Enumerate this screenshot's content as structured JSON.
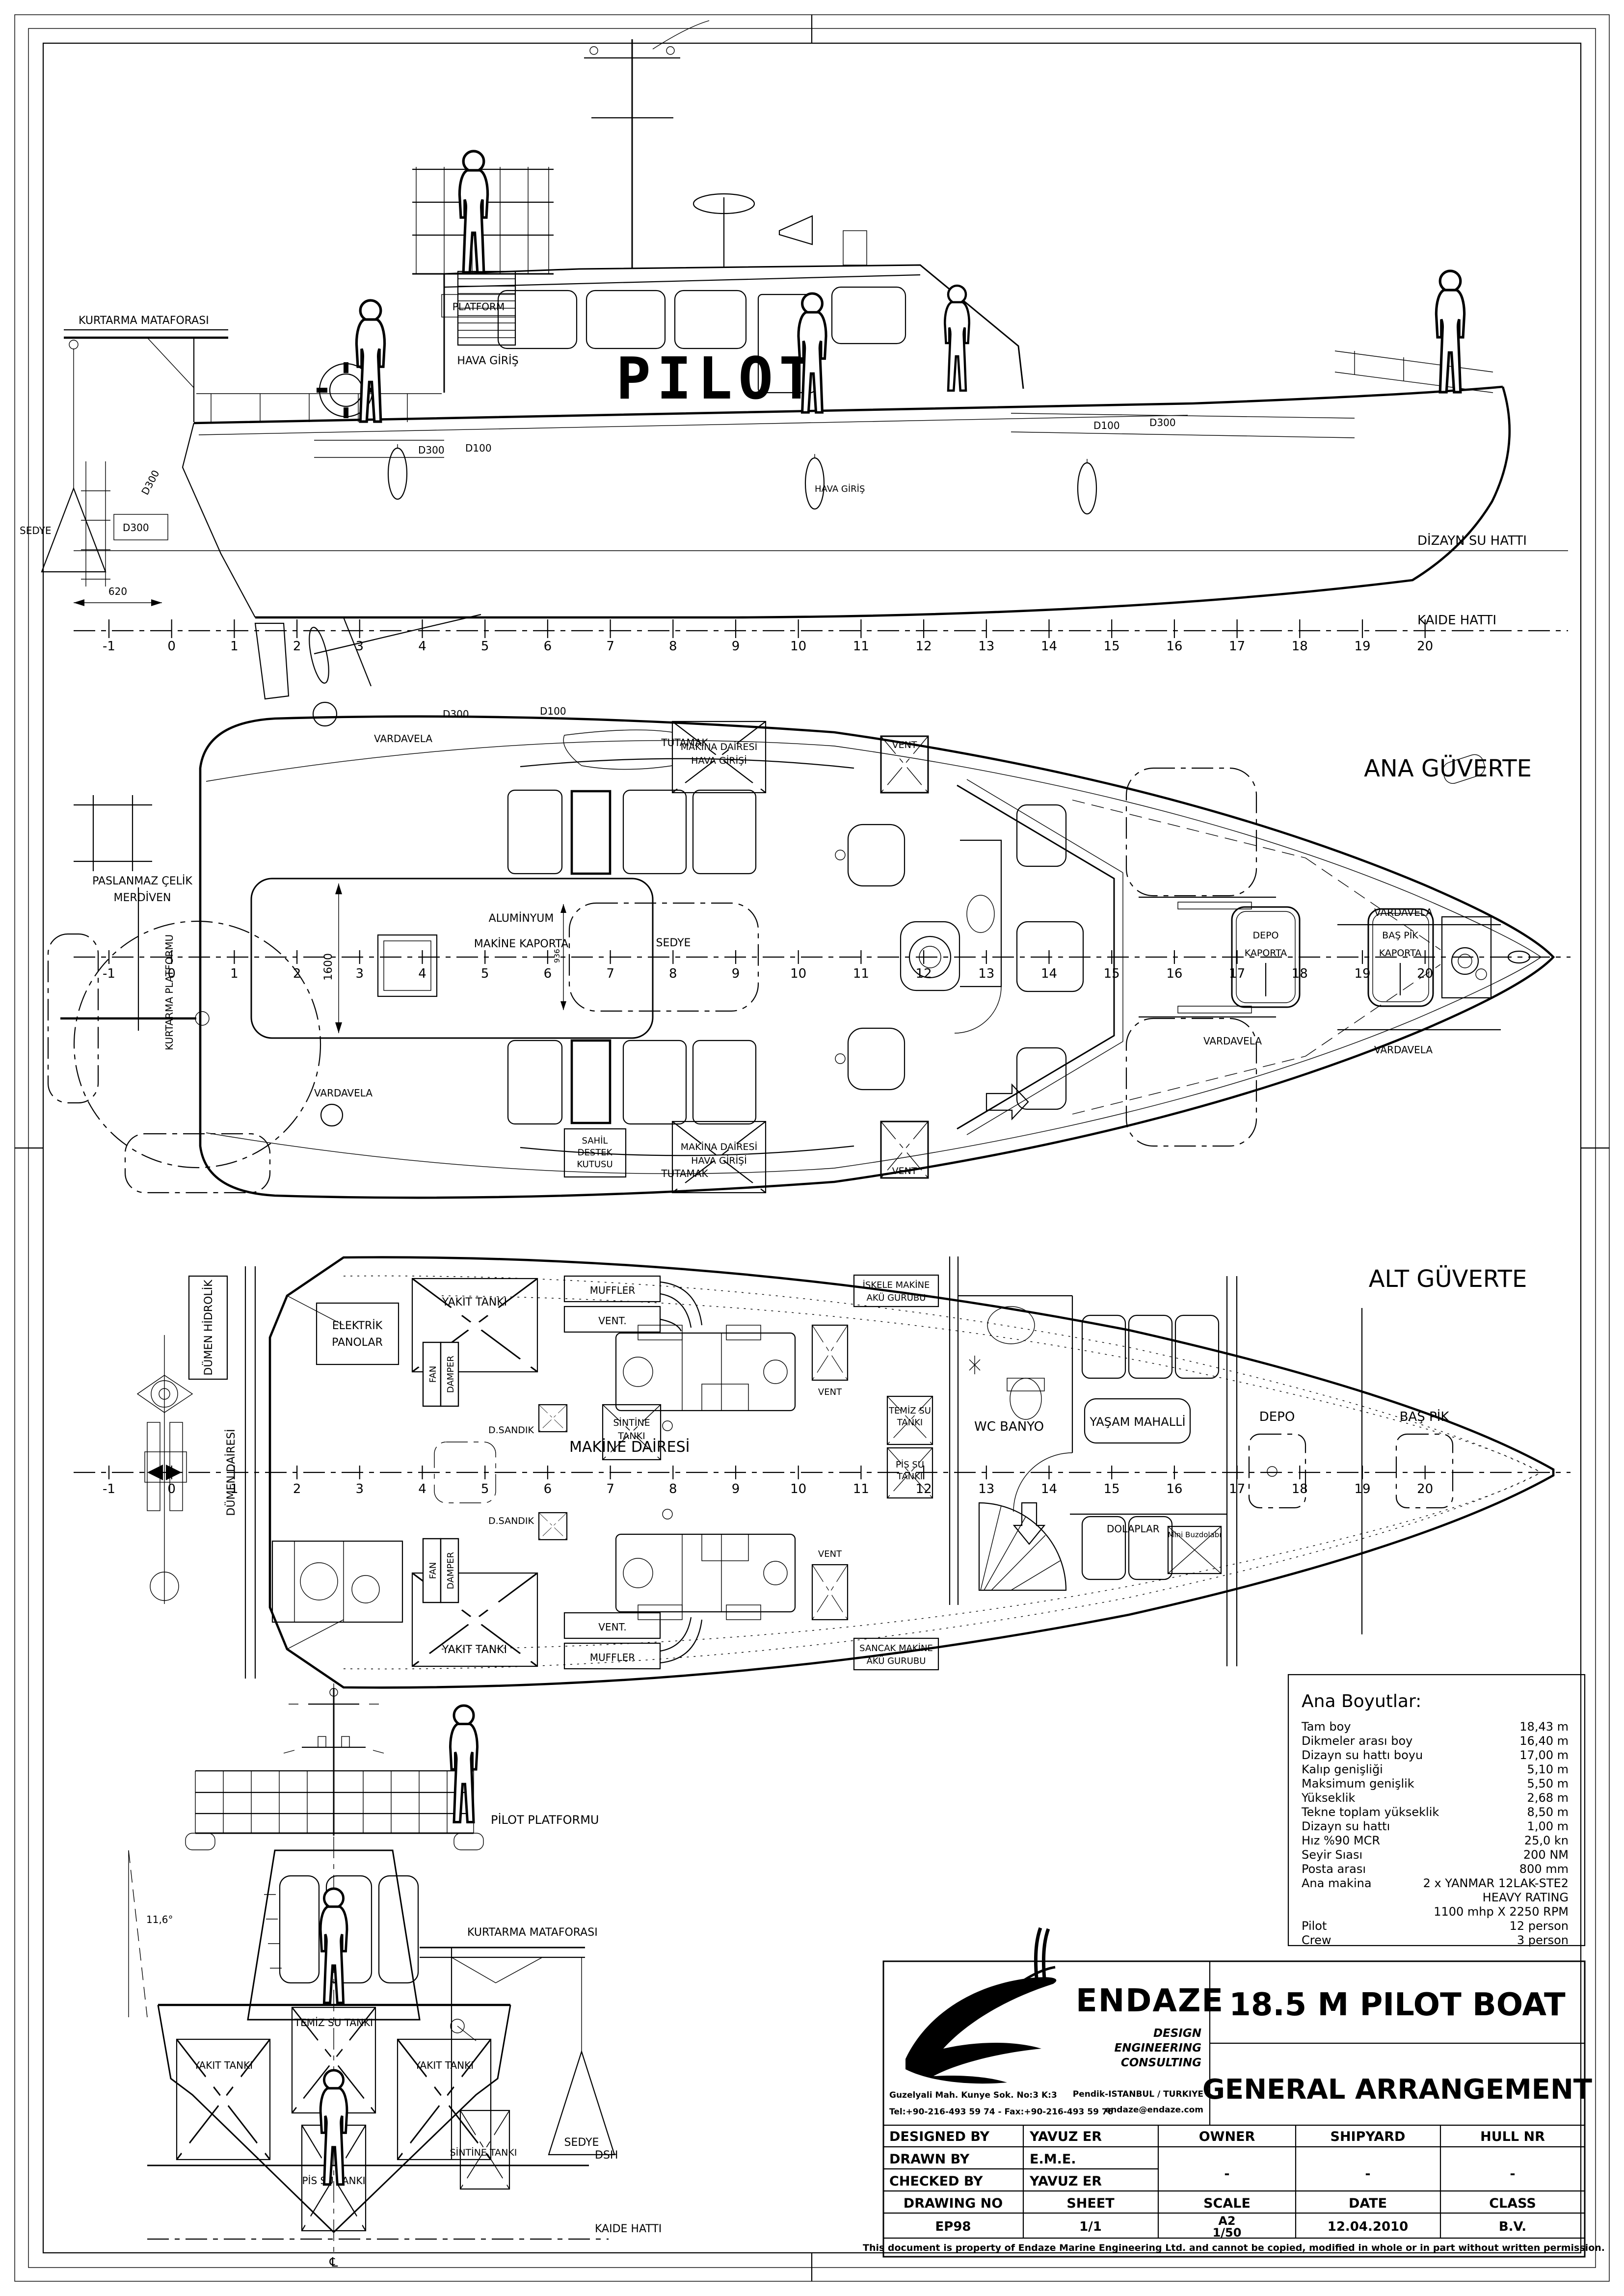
{
  "stations": [
    "-1",
    "0",
    "1",
    "2",
    "3",
    "4",
    "5",
    "6",
    "7",
    "8",
    "9",
    "10",
    "11",
    "12",
    "13",
    "14",
    "15",
    "16",
    "17",
    "18",
    "19",
    "20"
  ],
  "profile": {
    "kurtarma_mataforasi": "KURTARMA MATAFORASI",
    "sedye": "SEDYE",
    "dim_620": "620",
    "d300_stern_rot": "D300",
    "d300_stern": "D300",
    "platform": "PLATFORM",
    "hava_giris": "HAVA GİRİŞ",
    "hava_giris_2": "HAVA GİRİŞ",
    "pilot": "PILOT",
    "d300_aft": "D300",
    "d100_aft": "D100",
    "d100_fwd": "D100",
    "d300_fwd": "D300",
    "dizayn_su_hatti": "DİZAYN SU HATTI",
    "kaide_hatti": "KAIDE HATTI"
  },
  "main_deck": {
    "title": "ANA GÜVERTE",
    "vardavela_stern_top": "VARDAVELA",
    "vardavela_stern_bottom": "VARDAVELA",
    "vardavela_mid_bottom": "VARDAVELA",
    "vardavela_bow_top": "VARDAVELA",
    "vardavela_bow_bottom": "VARDAVELA",
    "d300": "D300",
    "d100": "D100",
    "tutamak_top": "TUTAMAK",
    "tutamak_bottom": "TUTAMAK",
    "paslanmaz_1": "PASLANMAZ ÇELİK",
    "paslanmaz_2": "MERDİVEN",
    "kurtarma_platformu": "KURTARMA PLATFORMU",
    "aluminyum": "ALUMİNYUM",
    "makine_kaporta": "MAKİNE KAPORTA",
    "dim_1600": "1600",
    "dim_936": "936",
    "sedye": "SEDYE",
    "hava_girisi_1": "MAKİNA DAİRESİ",
    "hava_girisi_2": "HAVA GİRİŞİ",
    "sahil_1": "SAHİL",
    "sahil_2": "DESTEK",
    "sahil_3": "KUTUSU",
    "vent_top": "VENT",
    "vent_bottom": "VENT",
    "depo_kaporta_1": "DEPO",
    "depo_kaporta_2": "KAPORTA",
    "bas_pik_kaporta_1": "BAŞ PİK",
    "bas_pik_kaporta_2": "KAPORTA"
  },
  "lower_deck": {
    "title": "ALT GÜVERTE",
    "elektrik_1": "ELEKTRİK",
    "elektrik_2": "PANOLAR",
    "yakit_tanki_top": "YAKIT TANKI",
    "yakit_tanki_bottom": "YAKIT TANKI",
    "fan_top": "FAN",
    "damper_top": "DAMPER",
    "fan_bottom": "FAN",
    "damper_bottom": "DAMPER",
    "muffler_top": "MUFFLER",
    "vent_dot_top": "VENT.",
    "muffler_bottom": "MUFFLER",
    "vent_dot_bottom": "VENT.",
    "vent_mid_top": "VENT",
    "vent_mid_bottom": "VENT",
    "iskele_1": "İSKELE MAKİNE",
    "iskele_2": "AKÜ GURUBU",
    "sancak_1": "SANCAK MAKİNE",
    "sancak_2": "AKÜ GURUBU",
    "makine_dairesi": "MAKİNE DAİRESİ",
    "d_sandik_top": "D.SANDIK",
    "d_sandik_bottom": "D.SANDIK",
    "sintine_1": "SİNTİNE",
    "sintine_2": "TANKI",
    "temiz_1": "TEMİZ SU",
    "temiz_2": "TANKI",
    "pis_1": "PİS SU",
    "pis_2": "TANKI",
    "dumen_hidrolik": "DÜMEN HİDROLİK",
    "dumen_dairesi": "DÜMEN DAİRESİ",
    "wc_banyo": "WC BANYO",
    "yasam_mahalli": "YAŞAM MAHALLİ",
    "dolaplar": "DOLAPLAR",
    "mini_buzdolabi": "Mini Buzdolabı",
    "depo": "DEPO",
    "bas_pik": "BAŞ PİK"
  },
  "bow": {
    "pilot_platformu": "PİLOT PLATFORMU",
    "kurtarma_mataforasi": "KURTARMA MATAFORASI",
    "angle": "11,6°",
    "yakit_left": "YAKIT TANKI",
    "yakit_right": "YAKIT TANKI",
    "temiz": "TEMİZ SU TANKI",
    "pis": "PİS SU TANKI",
    "sintine": "SİNTİNE TANKI",
    "sedye": "SEDYE",
    "dsh": "DSH",
    "kaide_hatti": "KAIDE HATTI",
    "cl": "℄"
  },
  "specs": {
    "title": "Ana Boyutlar:",
    "rows": [
      {
        "l": "Tam boy",
        "v": "18,43 m"
      },
      {
        "l": "Dikmeler arası boy",
        "v": "16,40 m"
      },
      {
        "l": "Dizayn su hattı boyu",
        "v": "17,00 m"
      },
      {
        "l": "Kalıp genişliği",
        "v": "5,10 m"
      },
      {
        "l": "Maksimum genişlik",
        "v": "5,50 m"
      },
      {
        "l": "Yükseklik",
        "v": "2,68 m"
      },
      {
        "l": "Tekne toplam yükseklik",
        "v": "8,50 m"
      },
      {
        "l": "Dizayn su hattı",
        "v": "1,00 m"
      },
      {
        "l": "Hız %90 MCR",
        "v": "25,0 kn"
      },
      {
        "l": "Seyir Sıası",
        "v": "200 NM"
      },
      {
        "l": "Posta arası",
        "v": "800 mm"
      },
      {
        "l": "Ana makina",
        "v": "2 x YANMAR 12LAK-STE2"
      },
      {
        "l": "",
        "v": "HEAVY RATING"
      },
      {
        "l": "",
        "v": "1100 mhp X 2250 RPM"
      },
      {
        "l": "Pilot",
        "v": "12 person"
      },
      {
        "l": "Crew",
        "v": "3 person"
      }
    ]
  },
  "title_block": {
    "company": "ENDAZE",
    "tagline_1": "DESIGN",
    "tagline_2": "ENGINEERING",
    "tagline_3": "CONSULTING",
    "address_l1": "Guzelyali Mah. Kunye Sok. No:3 K:3",
    "address_l2": "Tel:+90-216-493 59 74 - Fax:+90-216-493 59 76",
    "address_r1": "Pendik-ISTANBUL / TURKIYE",
    "address_r2": "endaze@endaze.com",
    "project": "18.5 M PILOT BOAT",
    "drawing_title": "GENERAL ARRANGEMENT",
    "designed_by_label": "DESIGNED BY",
    "designed_by": "YAVUZ ER",
    "drawn_by_label": "DRAWN BY",
    "drawn_by": "E.M.E.",
    "checked_by_label": "CHECKED BY",
    "checked_by": "YAVUZ ER",
    "owner_label": "OWNER",
    "owner": "-",
    "shipyard_label": "SHIPYARD",
    "shipyard": "-",
    "hull_nr_label": "HULL NR",
    "hull_nr": "-",
    "drawing_no_label": "DRAWING NO",
    "drawing_no": "EP98",
    "sheet_label": "SHEET",
    "sheet": "1/1",
    "scale_label": "SCALE",
    "scale_1": "A2",
    "scale_2": "1/50",
    "date_label": "DATE",
    "date": "12.04.2010",
    "class_label": "CLASS",
    "class": "B.V.",
    "copyright": "This document is property of  Endaze Marine Engineering Ltd. and cannot be copied, modified in whole or in part without written permission."
  }
}
